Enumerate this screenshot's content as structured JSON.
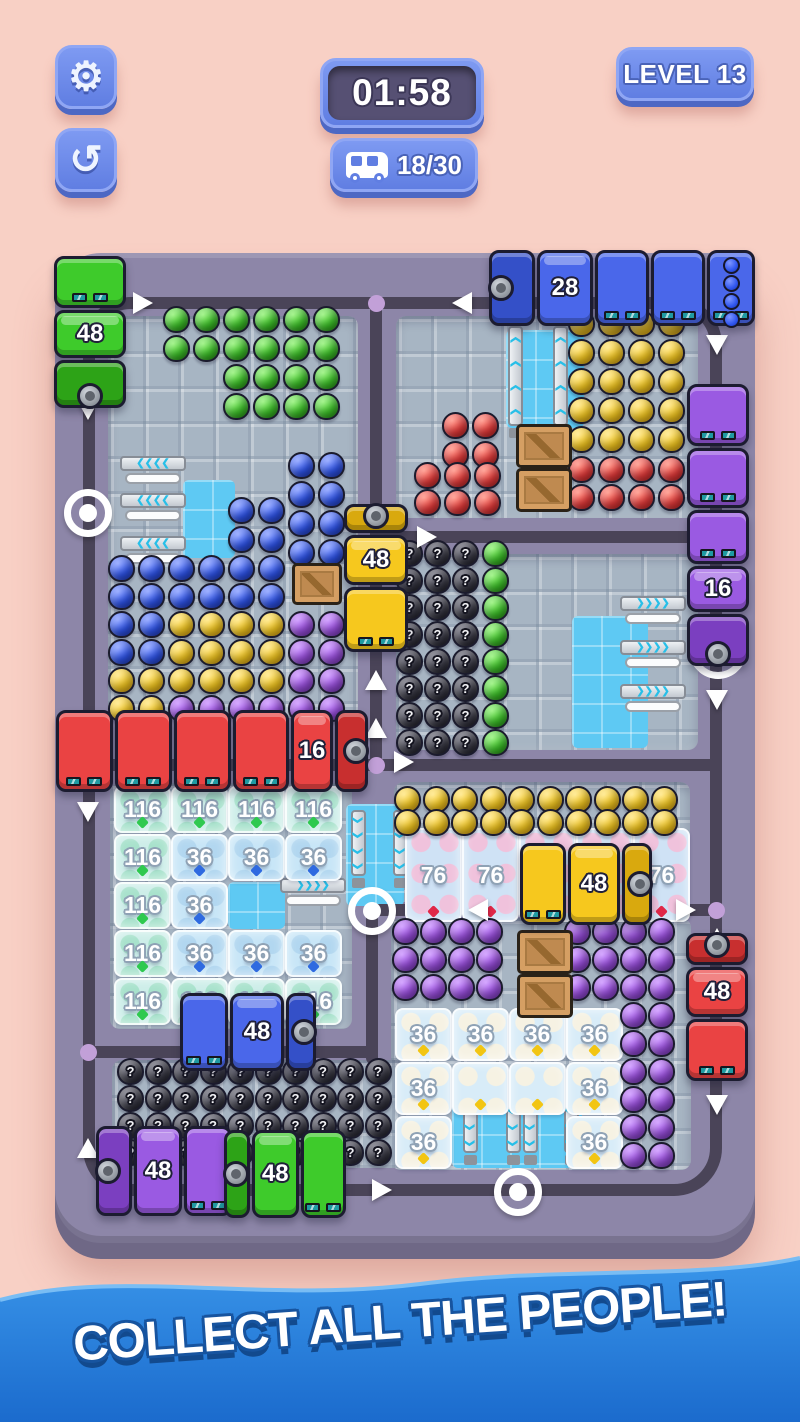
{
  "hud": {
    "timer": "01:58",
    "level": "LEVEL 13",
    "counter": "18/30",
    "settings_icon": "gear-icon",
    "undo_icon": "undo-arrow-icon",
    "counter_icon": "bus-icon"
  },
  "banner": {
    "text": "COLLECT ALL THE PEOPLE!"
  },
  "colors": {
    "background": "#f8d0c5",
    "button_blue": "#6d89ec",
    "button_blue_dark": "#4d68c4",
    "timer_inner": "#565073",
    "board": "#8d86a8",
    "board_edge": "#6f6886",
    "road": "#4a4458",
    "tile": "#a7b5c3",
    "tile_blue": "#5ec9f3",
    "banner_top": "#3a96ea",
    "banner_bottom": "#1b6bcd"
  },
  "board": {
    "palette": {
      "G": [
        "#8af06c",
        "#3ec42a",
        "#1f7d10"
      ],
      "B": [
        "#7f97ff",
        "#2f55ef",
        "#1c34a8"
      ],
      "Y": [
        "#ffe477",
        "#f6c91f",
        "#c79210"
      ],
      "R": [
        "#ff8a7a",
        "#e73b3b",
        "#a81f1f"
      ],
      "P": [
        "#c78bff",
        "#9b4fe0",
        "#6d2fa8"
      ],
      "K": [
        "#6a6a78",
        "#3a3a46",
        "#15151e"
      ]
    },
    "busColors": {
      "green": [
        "#3ecb2b",
        "#2da317"
      ],
      "blue": [
        "#4a67ea",
        "#3450c8"
      ],
      "yellow": [
        "#f6c81e",
        "#d9a90e"
      ],
      "red": [
        "#ea4343",
        "#c82f2f"
      ],
      "purple": [
        "#9a5ae2",
        "#7b3fc0"
      ]
    },
    "rooms": [
      {
        "x": 53,
        "y": 63,
        "w": 250,
        "h": 402
      },
      {
        "x": 341,
        "y": 63,
        "w": 302,
        "h": 202
      },
      {
        "x": 341,
        "y": 301,
        "w": 302,
        "h": 196
      },
      {
        "x": 55,
        "y": 530,
        "w": 242,
        "h": 246
      },
      {
        "x": 339,
        "y": 529,
        "w": 296,
        "h": 120
      },
      {
        "x": 336,
        "y": 665,
        "w": 300,
        "h": 252
      },
      {
        "x": 57,
        "y": 807,
        "w": 294,
        "h": 108
      }
    ],
    "patches": [
      {
        "x": 128,
        "y": 227,
        "w": 52,
        "h": 78
      },
      {
        "x": 451,
        "y": 77,
        "w": 78,
        "h": 98
      },
      {
        "x": 517,
        "y": 363,
        "w": 76,
        "h": 132
      },
      {
        "x": 291,
        "y": 551,
        "w": 58,
        "h": 102
      },
      {
        "x": 397,
        "y": 823,
        "w": 130,
        "h": 92
      },
      {
        "x": 173,
        "y": 629,
        "w": 57,
        "h": 47
      }
    ],
    "ring_road": {
      "x": 28,
      "y": 44,
      "w": 639,
      "h": 899
    },
    "roads": [
      {
        "x": 315,
        "y": 50,
        "w": 12,
        "h": 462
      },
      {
        "x": 321,
        "y": 278,
        "w": 340,
        "h": 12
      },
      {
        "x": 34,
        "y": 506,
        "w": 627,
        "h": 12
      },
      {
        "x": 317,
        "y": 651,
        "w": 344,
        "h": 12
      },
      {
        "x": 311,
        "y": 651,
        "w": 12,
        "h": 160
      },
      {
        "x": 34,
        "y": 793,
        "w": 289,
        "h": 12
      }
    ],
    "dots": [
      {
        "x": 321,
        "y": 50
      },
      {
        "x": 321,
        "y": 512
      },
      {
        "x": 661,
        "y": 657
      },
      {
        "x": 33,
        "y": 799
      }
    ],
    "rings": [
      {
        "x": 33,
        "y": 260
      },
      {
        "x": 317,
        "y": 658
      },
      {
        "x": 463,
        "y": 939
      }
    ],
    "arrows": [
      {
        "x": 88,
        "y": 50,
        "d": "R"
      },
      {
        "x": 407,
        "y": 50,
        "d": "L"
      },
      {
        "x": 33,
        "y": 157,
        "d": "D"
      },
      {
        "x": 662,
        "y": 92,
        "d": "D"
      },
      {
        "x": 662,
        "y": 447,
        "d": "D"
      },
      {
        "x": 321,
        "y": 263,
        "d": "U"
      },
      {
        "x": 372,
        "y": 284,
        "d": "R"
      },
      {
        "x": 321,
        "y": 427,
        "d": "U"
      },
      {
        "x": 321,
        "y": 475,
        "d": "U"
      },
      {
        "x": 349,
        "y": 509,
        "d": "R"
      },
      {
        "x": 33,
        "y": 559,
        "d": "D"
      },
      {
        "x": 423,
        "y": 657,
        "d": "L"
      },
      {
        "x": 631,
        "y": 657,
        "d": "R"
      },
      {
        "x": 662,
        "y": 685,
        "d": "U"
      },
      {
        "x": 662,
        "y": 852,
        "d": "D"
      },
      {
        "x": 33,
        "y": 895,
        "d": "U"
      },
      {
        "x": 327,
        "y": 937,
        "d": "R"
      }
    ],
    "conveyors": [
      {
        "x": 65,
        "y": 203,
        "d": "L",
        "len": 66
      },
      {
        "x": 65,
        "y": 240,
        "d": "L",
        "len": 66
      },
      {
        "x": 65,
        "y": 283,
        "d": "L",
        "len": 66
      },
      {
        "x": 451,
        "y": 73,
        "d": "U",
        "len": 112
      },
      {
        "x": 496,
        "y": 73,
        "d": "U",
        "len": 112
      },
      {
        "x": 565,
        "y": 343,
        "d": "R",
        "len": 66
      },
      {
        "x": 565,
        "y": 387,
        "d": "R",
        "len": 66
      },
      {
        "x": 565,
        "y": 431,
        "d": "R",
        "len": 66
      },
      {
        "x": 225,
        "y": 625,
        "d": "R",
        "len": 66
      },
      {
        "x": 294,
        "y": 557,
        "d": "D",
        "len": 78
      },
      {
        "x": 336,
        "y": 557,
        "d": "D",
        "len": 78
      },
      {
        "x": 406,
        "y": 832,
        "d": "D",
        "len": 80
      },
      {
        "x": 449,
        "y": 832,
        "d": "D",
        "len": 80
      },
      {
        "x": 466,
        "y": 832,
        "d": "D",
        "len": 80
      },
      {
        "x": 507,
        "y": 832,
        "d": "D",
        "len": 80
      }
    ],
    "crates": [
      {
        "x": 237,
        "y": 310,
        "w": 50,
        "h": 42
      },
      {
        "x": 461,
        "y": 171,
        "w": 56,
        "h": 44
      },
      {
        "x": 461,
        "y": 215,
        "w": 56,
        "h": 44
      },
      {
        "x": 462,
        "y": 677,
        "w": 56,
        "h": 44
      },
      {
        "x": 462,
        "y": 721,
        "w": 56,
        "h": 44
      }
    ],
    "ice_cells": [
      {
        "x": 59,
        "y": 533,
        "w": 57,
        "h": 47,
        "v": "116",
        "t": "t116"
      },
      {
        "x": 116,
        "y": 533,
        "w": 57,
        "h": 47,
        "v": "116",
        "t": "t116"
      },
      {
        "x": 173,
        "y": 533,
        "w": 57,
        "h": 47,
        "v": "116",
        "t": "t116"
      },
      {
        "x": 230,
        "y": 533,
        "w": 57,
        "h": 47,
        "v": "116",
        "t": "t116"
      },
      {
        "x": 59,
        "y": 581,
        "w": 57,
        "h": 47,
        "v": "116",
        "t": "t116"
      },
      {
        "x": 116,
        "y": 581,
        "w": 57,
        "h": 47,
        "v": "36",
        "t": "t36"
      },
      {
        "x": 173,
        "y": 581,
        "w": 57,
        "h": 47,
        "v": "36",
        "t": "t36"
      },
      {
        "x": 230,
        "y": 581,
        "w": 57,
        "h": 47,
        "v": "36",
        "t": "t36"
      },
      {
        "x": 59,
        "y": 629,
        "w": 57,
        "h": 47,
        "v": "116",
        "t": "t116"
      },
      {
        "x": 116,
        "y": 629,
        "w": 57,
        "h": 47,
        "v": "36",
        "t": "t36"
      },
      {
        "x": 59,
        "y": 677,
        "w": 57,
        "h": 47,
        "v": "116",
        "t": "t116"
      },
      {
        "x": 116,
        "y": 677,
        "w": 57,
        "h": 47,
        "v": "36",
        "t": "t36"
      },
      {
        "x": 173,
        "y": 677,
        "w": 57,
        "h": 47,
        "v": "36",
        "t": "t36"
      },
      {
        "x": 230,
        "y": 677,
        "w": 57,
        "h": 47,
        "v": "36",
        "t": "t36"
      },
      {
        "x": 59,
        "y": 725,
        "w": 57,
        "h": 47,
        "v": "116",
        "t": "t116"
      },
      {
        "x": 116,
        "y": 725,
        "w": 57,
        "h": 47,
        "v": "116",
        "t": "t116"
      },
      {
        "x": 173,
        "y": 725,
        "w": 57,
        "h": 47,
        "v": "116",
        "t": "t116"
      },
      {
        "x": 230,
        "y": 725,
        "w": 57,
        "h": 47,
        "v": "116",
        "t": "t116"
      },
      {
        "x": 350,
        "y": 575,
        "w": 57,
        "h": 94,
        "v": "76",
        "t": "t76"
      },
      {
        "x": 407,
        "y": 575,
        "w": 57,
        "h": 94,
        "v": "76",
        "t": "t76"
      },
      {
        "x": 464,
        "y": 575,
        "w": 57,
        "h": 94,
        "v": "76",
        "t": "t76"
      },
      {
        "x": 521,
        "y": 575,
        "w": 57,
        "h": 94,
        "v": "76",
        "t": "t76"
      },
      {
        "x": 578,
        "y": 575,
        "w": 57,
        "h": 94,
        "v": "76",
        "t": "t76"
      },
      {
        "x": 340,
        "y": 755,
        "w": 57,
        "h": 53,
        "v": "36",
        "t": "tegg"
      },
      {
        "x": 397,
        "y": 755,
        "w": 57,
        "h": 53,
        "v": "36",
        "t": "tegg"
      },
      {
        "x": 454,
        "y": 755,
        "w": 57,
        "h": 53,
        "v": "36",
        "t": "tegg"
      },
      {
        "x": 511,
        "y": 755,
        "w": 57,
        "h": 53,
        "v": "36",
        "t": "tegg"
      },
      {
        "x": 340,
        "y": 809,
        "w": 57,
        "h": 53,
        "v": "36",
        "t": "tegg"
      },
      {
        "x": 397,
        "y": 809,
        "w": 57,
        "h": 53,
        "v": "",
        "t": "tegg"
      },
      {
        "x": 454,
        "y": 809,
        "w": 57,
        "h": 53,
        "v": "",
        "t": "tegg"
      },
      {
        "x": 511,
        "y": 809,
        "w": 57,
        "h": 53,
        "v": "36",
        "t": "tegg"
      },
      {
        "x": 340,
        "y": 863,
        "w": 57,
        "h": 53,
        "v": "36",
        "t": "tegg"
      },
      {
        "x": 511,
        "y": 863,
        "w": 57,
        "h": 53,
        "v": "36",
        "t": "tegg"
      }
    ],
    "crowds": [
      {
        "c": "G",
        "x": 108,
        "y": 53,
        "cols": 6,
        "rows": 2,
        "px": 30,
        "py": 29
      },
      {
        "c": "G",
        "x": 168,
        "y": 111,
        "cols": 4,
        "rows": 2,
        "px": 30,
        "py": 29
      },
      {
        "c": "B",
        "x": 233,
        "y": 199,
        "cols": 2,
        "rows": 4,
        "px": 30,
        "py": 29
      },
      {
        "c": "B",
        "x": 173,
        "y": 244,
        "cols": 2,
        "rows": 2,
        "px": 30,
        "py": 29
      },
      {
        "grid": [
          "BBBBBB..",
          "BBBBBB..",
          "BBYYYYPP",
          "BBYYYYPP",
          "YYYYYYPP",
          "YYPPPPPP"
        ],
        "x": 53,
        "y": 302,
        "px": 30,
        "py": 28
      },
      {
        "c": "R",
        "x": 387,
        "y": 159,
        "cols": 2,
        "rows": 2,
        "px": 30,
        "py": 29
      },
      {
        "c": "R",
        "x": 359,
        "y": 209,
        "cols": 3,
        "rows": 2,
        "px": 30,
        "py": 27
      },
      {
        "c": "Y",
        "x": 513,
        "y": 57,
        "cols": 4,
        "rows": 5,
        "px": 30,
        "py": 29
      },
      {
        "c": "R",
        "x": 513,
        "y": 203,
        "cols": 4,
        "rows": 2,
        "px": 30,
        "py": 28
      },
      {
        "c": "K",
        "x": 341,
        "y": 287,
        "cols": 3,
        "rows": 8,
        "px": 28,
        "py": 27
      },
      {
        "c": "G",
        "x": 427,
        "y": 287,
        "cols": 1,
        "rows": 8,
        "px": 28,
        "py": 27
      },
      {
        "c": "Y",
        "x": 339,
        "y": 533,
        "cols": 10,
        "rows": 2,
        "px": 28.5,
        "py": 23
      },
      {
        "c": "P",
        "x": 337,
        "y": 665,
        "cols": 4,
        "rows": 3,
        "px": 28,
        "py": 28
      },
      {
        "c": "P",
        "x": 509,
        "y": 665,
        "cols": 4,
        "rows": 3,
        "px": 28,
        "py": 28
      },
      {
        "c": "P",
        "x": 565,
        "y": 749,
        "cols": 2,
        "rows": 6,
        "px": 28,
        "py": 28
      },
      {
        "c": "K",
        "x": 62,
        "y": 805,
        "cols": 10,
        "rows": 4,
        "px": 27.5,
        "py": 27
      }
    ],
    "buses": [
      {
        "id": "green-top-left",
        "color": "green",
        "number": "48",
        "x": -1,
        "y": 3,
        "w": 72,
        "h": 152,
        "dir": "down",
        "segs": [
          {
            "t": "wagon",
            "len": 52
          },
          {
            "t": "cab",
            "len": 48,
            "num": "48"
          },
          {
            "t": "engine",
            "len": 48
          }
        ]
      },
      {
        "id": "blue-top",
        "color": "blue",
        "number": "28",
        "x": 434,
        "y": -3,
        "w": 266,
        "h": 76,
        "dir": "left",
        "segs": [
          {
            "t": "engine",
            "len": 46
          },
          {
            "t": "cab",
            "len": 56,
            "num": "28"
          },
          {
            "t": "wagon",
            "len": 54
          },
          {
            "t": "wagon",
            "len": 54
          },
          {
            "t": "load",
            "len": 48
          }
        ]
      },
      {
        "id": "purple-right",
        "color": "purple",
        "number": "16",
        "x": 632,
        "y": 131,
        "w": 62,
        "h": 282,
        "dir": "down",
        "segs": [
          {
            "t": "wagon",
            "len": 62
          },
          {
            "t": "wagon",
            "len": 60
          },
          {
            "t": "wagon",
            "len": 54
          },
          {
            "t": "cab",
            "len": 46,
            "num": "16"
          },
          {
            "t": "engine",
            "len": 52
          }
        ]
      },
      {
        "id": "yellow-center",
        "color": "yellow",
        "number": "48",
        "x": 289,
        "y": 251,
        "w": 64,
        "h": 148,
        "dir": "up",
        "segs": [
          {
            "t": "engine",
            "len": 28
          },
          {
            "t": "cab",
            "len": 50,
            "num": "48"
          },
          {
            "t": "wagon",
            "len": 64
          }
        ]
      },
      {
        "id": "red-train",
        "color": "red",
        "number": "16",
        "x": 1,
        "y": 457,
        "w": 312,
        "h": 82,
        "dir": "right",
        "segs": [
          {
            "t": "wagon",
            "len": 58
          },
          {
            "t": "wagon",
            "len": 58
          },
          {
            "t": "wagon",
            "len": 58
          },
          {
            "t": "wagon",
            "len": 58
          },
          {
            "t": "cab",
            "len": 42,
            "num": "16"
          },
          {
            "t": "engine",
            "len": 34
          }
        ]
      },
      {
        "id": "blue-lower-left",
        "color": "blue",
        "number": "48",
        "x": 125,
        "y": 740,
        "w": 136,
        "h": 78,
        "dir": "right",
        "segs": [
          {
            "t": "wagon",
            "len": 48
          },
          {
            "t": "cab",
            "len": 54,
            "num": "48"
          },
          {
            "t": "engine",
            "len": 30
          }
        ]
      },
      {
        "id": "yellow-mid-right",
        "color": "yellow",
        "number": "48",
        "x": 465,
        "y": 590,
        "w": 132,
        "h": 82,
        "dir": "right",
        "segs": [
          {
            "t": "wagon",
            "len": 46
          },
          {
            "t": "cab",
            "len": 52,
            "num": "48"
          },
          {
            "t": "engine",
            "len": 30
          }
        ]
      },
      {
        "id": "red-right",
        "color": "red",
        "number": "48",
        "x": 631,
        "y": 680,
        "w": 62,
        "h": 148,
        "dir": "up",
        "segs": [
          {
            "t": "engine",
            "len": 32
          },
          {
            "t": "cab",
            "len": 50,
            "num": "48"
          },
          {
            "t": "wagon",
            "len": 62
          }
        ]
      },
      {
        "id": "purple-bottom",
        "color": "purple",
        "number": "48",
        "x": 41,
        "y": 873,
        "w": 136,
        "h": 90,
        "dir": "left",
        "segs": [
          {
            "t": "engine",
            "len": 36
          },
          {
            "t": "cab",
            "len": 48,
            "num": "48"
          },
          {
            "t": "wagon",
            "len": 48
          }
        ]
      },
      {
        "id": "green-bottom",
        "color": "green",
        "number": "48",
        "x": 169,
        "y": 877,
        "w": 122,
        "h": 88,
        "dir": "left",
        "segs": [
          {
            "t": "engine",
            "len": 26
          },
          {
            "t": "cab",
            "len": 48,
            "num": "48"
          },
          {
            "t": "wagon",
            "len": 46
          }
        ]
      }
    ],
    "arcs": [
      {
        "x": 634,
        "y": 368
      }
    ],
    "question_mark": "?"
  }
}
